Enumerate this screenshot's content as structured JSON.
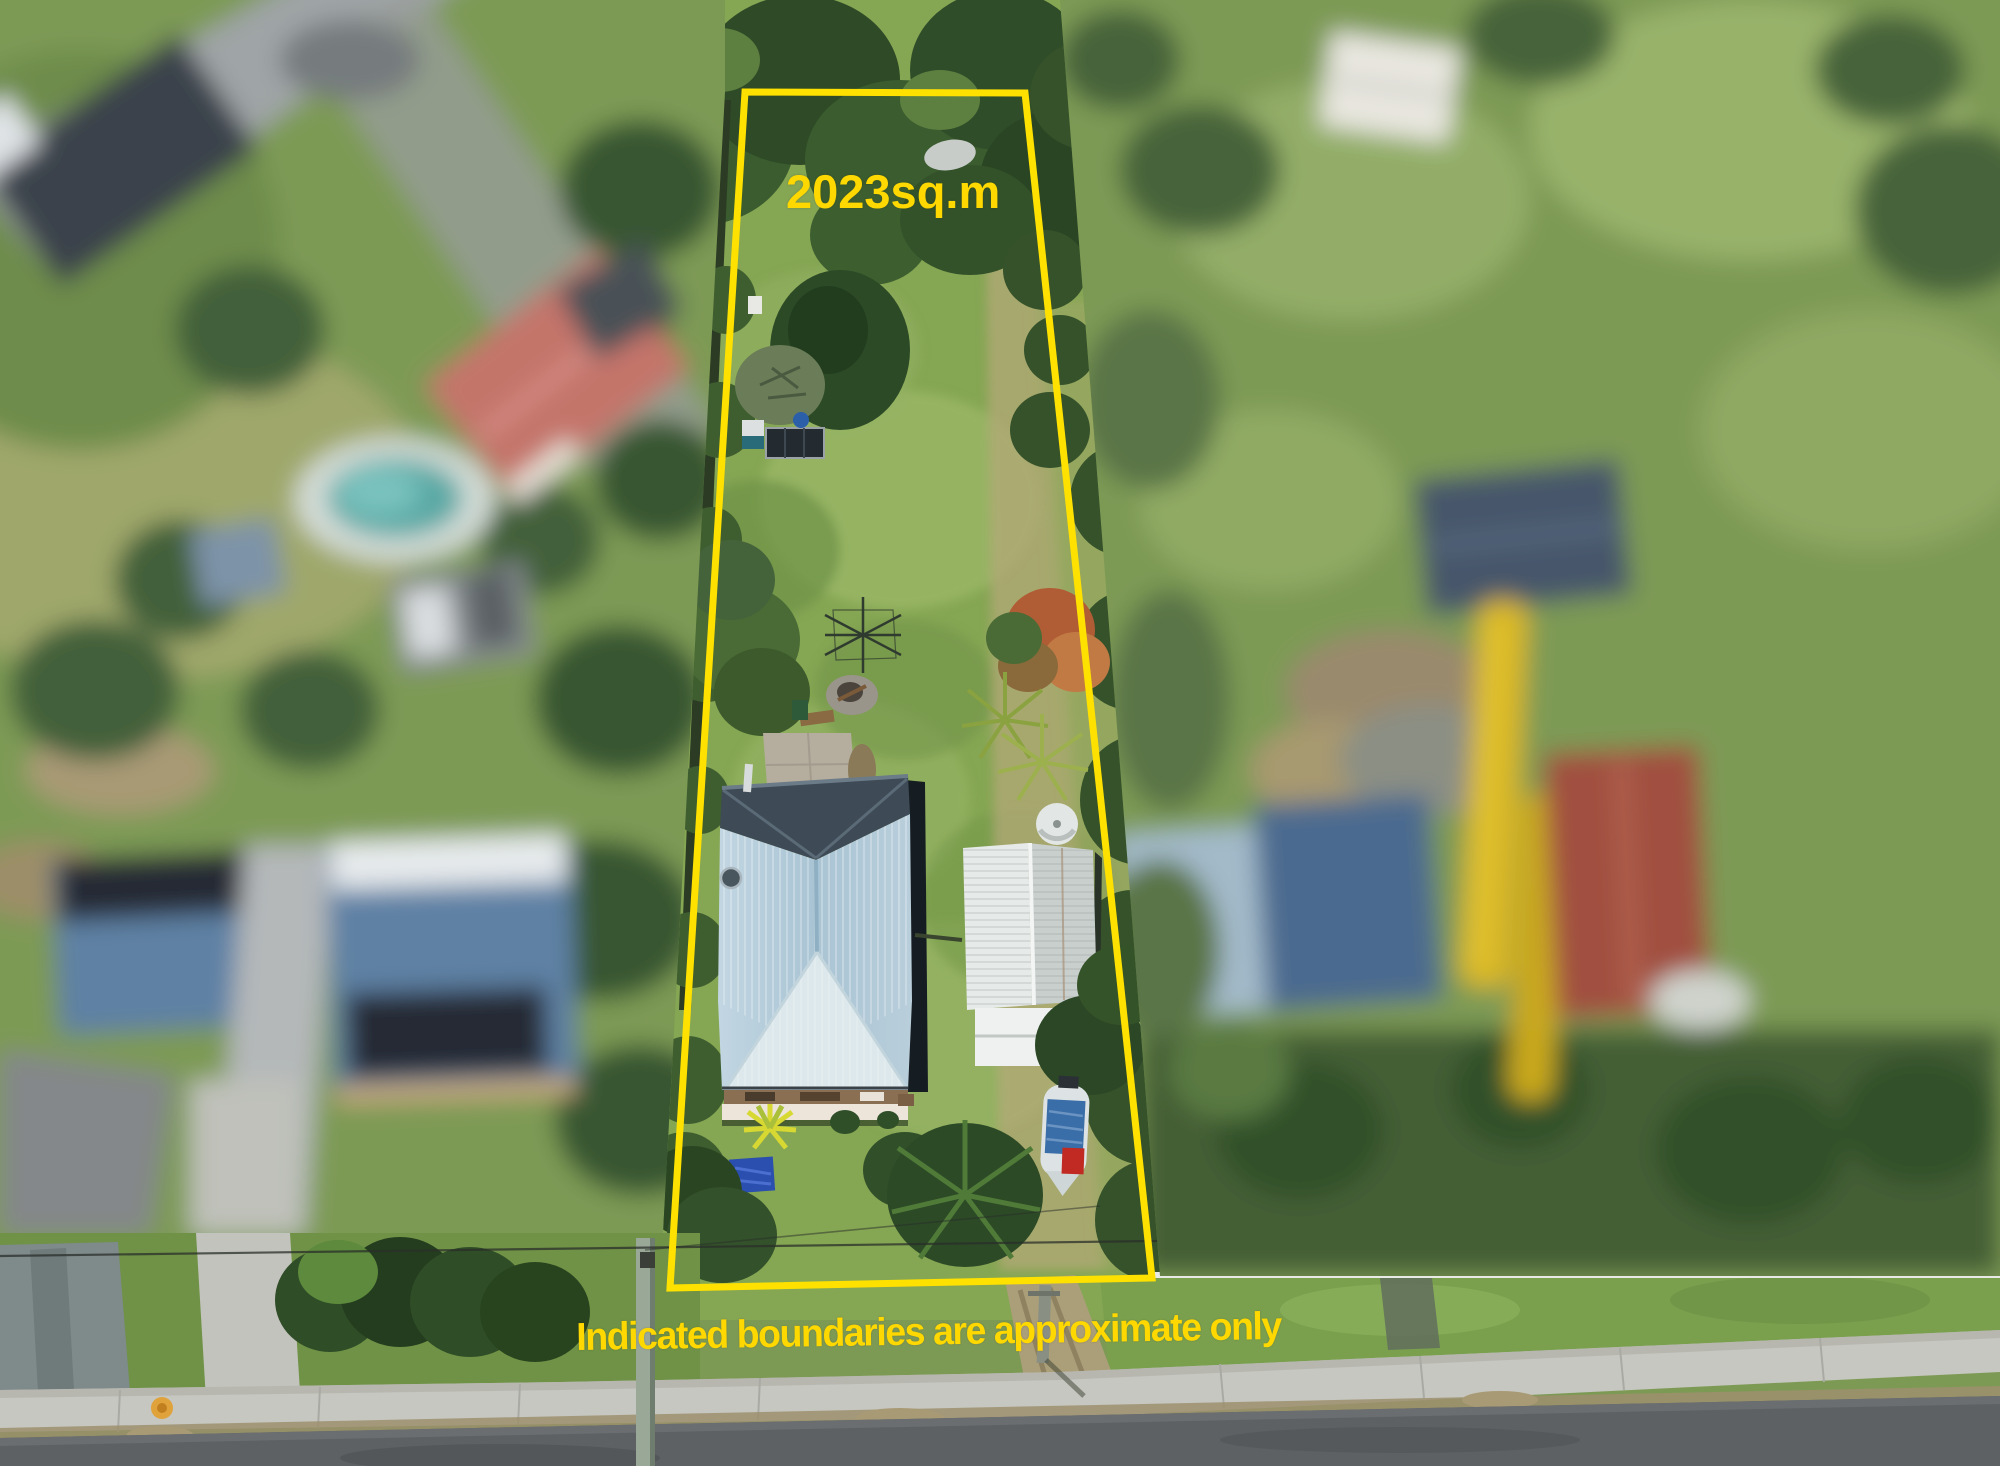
{
  "photo": {
    "description": "Aerial drone photograph of a long narrow residential block outlined in yellow; neighbouring properties are blurred, street frontage at bottom",
    "area_label": "2023sq.m",
    "disclaimer": "Indicated boundaries are approximate only",
    "boundary_color": "#ffe100",
    "label_color": "#ffd800",
    "boundary_points": "745,92 1025,93 1152,1278 670,1288"
  }
}
